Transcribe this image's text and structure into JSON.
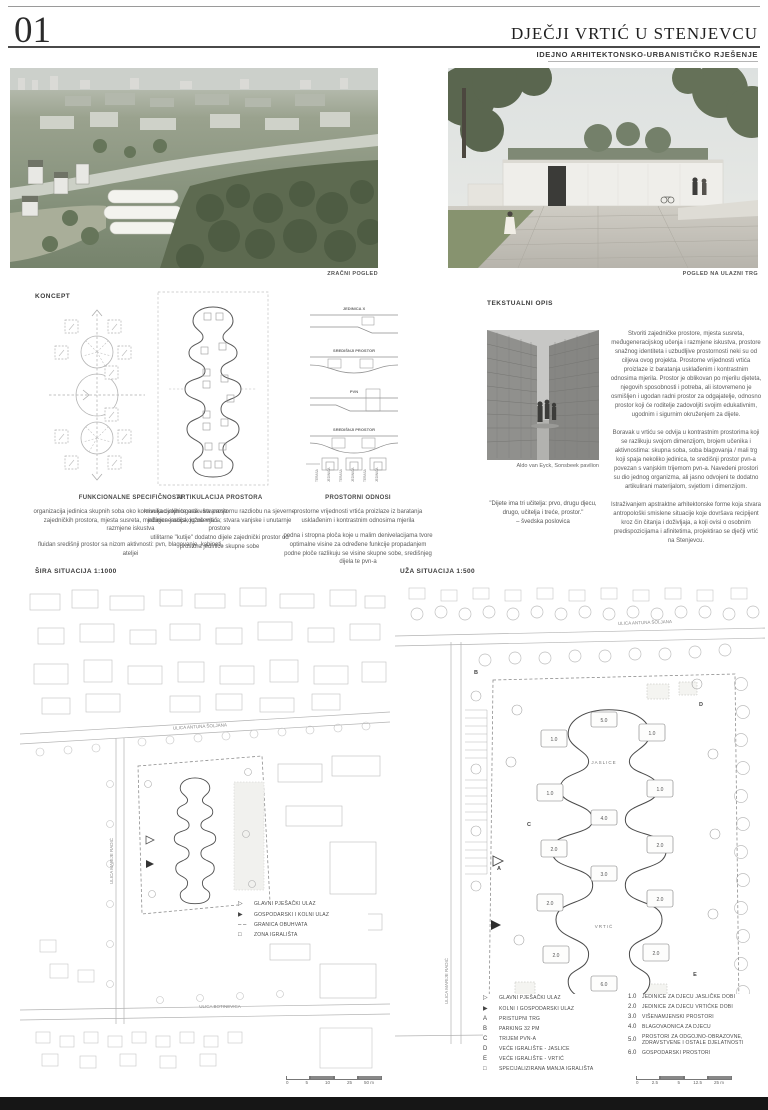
{
  "header": {
    "number": "01",
    "title": "DJEČJI VRTIĆ U STENJEVCU",
    "subtitle": "IDEJNO  ARHITEKTONSKO-URBANISTIČKO RJEŠENJE"
  },
  "renders": {
    "aerial_caption": "ZRAČNI POGLED",
    "entry_caption": "POGLED NA ULAZNI TRG"
  },
  "concept": {
    "label": "KONCEPT",
    "section_labels": [
      "JEDINICA X",
      "SREDIŠNJI PROSTOR",
      "PVN",
      "SREDIŠNJI PROSTOR"
    ],
    "strip_labels": [
      "TERASA",
      "JEDINICA",
      "TERASA",
      "JEDINICA",
      "TERASA",
      "JEDINICA"
    ],
    "columns": [
      {
        "heading": "FUNKCIONALNE SPECIFIČNOSTI",
        "p1": "organizacija jedinica skupnih soba oko komunikacijskih trgova - stvaranje zajedničkih prostora, mjesta susreta, međugeneracijskog učenja i razmjene iskustva",
        "p2": "fluidan središnji prostor sa nizom aktivnosti: pvn, blagovanje, kabineti, ateljei"
      },
      {
        "heading": "ARTIKULACIJA PROSTORA",
        "p1": "krivulja ovojnice artikulira prostornu razdiobu na sjeverne jedinice jaslica, južne vrtića; stvara vanjske i unutarnje prostore",
        "p2": "utilitarne \"kutije\" dodatno dijele zajednički prostor od prostora jedinice skupne sobe"
      },
      {
        "heading": "PROSTORNI ODNOSI",
        "p1": "prostorne vrijednosti vrtića proizlaze iz baratanja usklađenim i kontrastnim odnosima mjerila",
        "p2": "podna i stropna ploča koje u malim denivelacijama tvore optimalne visine za određene funkcije propadanjem podne ploče razlikuju se visine skupne sobe, središnjeg dijela te pvn-a"
      }
    ]
  },
  "textual": {
    "label": "TEKSTUALNI OPIS",
    "photo_caption": "Aldo van Eyck, Sonsbeek pavilion",
    "quote_line": "\"Dijete ima tri učitelja: prvo, drugu djecu, drugo, učitelja i treće, prostor.\"",
    "quote_attribution": "– švedska poslovica",
    "p1": "Stvoriti zajedničke prostore, mjesta susreta, međugeneracijskog učenja i razmjene iskustva, prostore snažnog identiteta i uzbudljive prostornosti neki su od ciljeva ovog projekta. Prostorne vrijednosti vrtića proizlaze iz baratanja usklađenim i kontrastnim odnosima mjerila. Prostor je oblikovan po mjerilu djeteta, njegovih sposobnosti i potreba, ali istovremeno je osmišljen i ugodan radni prostor za odgajatelje, odnosno prostor koji će roditelje zadovoljiti svojim edukativnim, ugodnim i sigurnim okruženjem za dijete.",
    "p2": "Boravak u vrtiću se odvija u kontrastnim prostorima koji se razlikuju svojom dimenzijom, brojem učenika i aktivnostima: skupna soba, soba blagovanja / mali trg koji spaja nekoliko jedinica, te središnji prostor pvn-a povezan s vanjskim trijemom pvn-a. Navedeni prostori su dio jednog organizma, ali jasno odvojeni te dodatno artikulirani materijalom, svjetlom i dimenzijom.",
    "p3": "Istraživanjem apstraktne arhitektonske forme koja stvara antropološki smislene situacije koje dovršava recipijent kroz čin čitanja i doživljaja, a koji ovisi o osobnim predispozicijama i afinitetima, projektirao se dječji vrtić na Stenjevcu."
  },
  "plans": {
    "wide": {
      "title": "ŠIRA SITUACIJA 1:1000",
      "street_top": "ULICA ANTUNA ŠOLJANA",
      "street_left": "ULICA MARIJE RADIĆ",
      "street_bottom": "ULICA BOTINEVICA",
      "legend": [
        {
          "key": "▷",
          "label": "GLAVNI PJEŠAČKI ULAZ"
        },
        {
          "key": "▶",
          "label": "GOSPODARSKI I KOLNI ULAZ"
        },
        {
          "key": "– –",
          "label": "GRANICA OBUHVATA"
        },
        {
          "key": "□",
          "label": "ZONA IGRALIŠTA"
        }
      ],
      "scale": [
        "0",
        "5",
        "10",
        "25",
        "50 m"
      ]
    },
    "close": {
      "title": "UŽA SITUACIJA 1:500",
      "street_top": "ULICA ANTUNA ŠOLJANA",
      "street_left": "ULICA MARIJE RADIĆ",
      "legend_a": [
        {
          "key": "▷",
          "label": "GLAVNI PJEŠAČKI ULAZ"
        },
        {
          "key": "▶",
          "label": "KOLNI I GOSPODARSKI ULAZ"
        },
        {
          "key": "A",
          "label": "PRISTUPNI TRG"
        },
        {
          "key": "B",
          "label": "PARKING 32 PM"
        },
        {
          "key": "C",
          "label": "TRIJEM PVN-A"
        },
        {
          "key": "D",
          "label": "VEĆE IGRALIŠTE - JASLICE"
        },
        {
          "key": "E",
          "label": "VEĆE IGRALIŠTE - VRTIĆ"
        },
        {
          "key": "□",
          "label": "SPECIJALIZIRANA MANJA IGRALIŠTA"
        }
      ],
      "legend_b": [
        {
          "key": "1.0",
          "label": "JEDINICE ZA DJECU JASLIČKE DOBI"
        },
        {
          "key": "2.0",
          "label": "JEDINICE ZA DJECU VRTIĆKE DOBI"
        },
        {
          "key": "3.0",
          "label": "VIŠENAMJENSKI PROSTORI"
        },
        {
          "key": "4.0",
          "label": "BLAGOVAONICA ZA DJECU"
        },
        {
          "key": "5.0",
          "label": "PROSTORI ZA ODGOJNO-OBRAZOVNE, ZDRAVSTVENE I OSTALE DJELATNOSTI"
        },
        {
          "key": "6.0",
          "label": "GOSPODARSKI PROSTORI"
        }
      ],
      "map": {
        "jaslice": "JASLICE",
        "vrtic": "VRTIĆ",
        "u1": "1.0",
        "u2": "2.0",
        "u3": "3.0",
        "u4": "4.0",
        "u5": "5.0",
        "u6": "6.0",
        "A": "A",
        "B": "B",
        "C": "C",
        "D": "D",
        "E": "E"
      },
      "scale": [
        "0",
        "2.5",
        "5",
        "12.5",
        "25 m"
      ]
    }
  }
}
